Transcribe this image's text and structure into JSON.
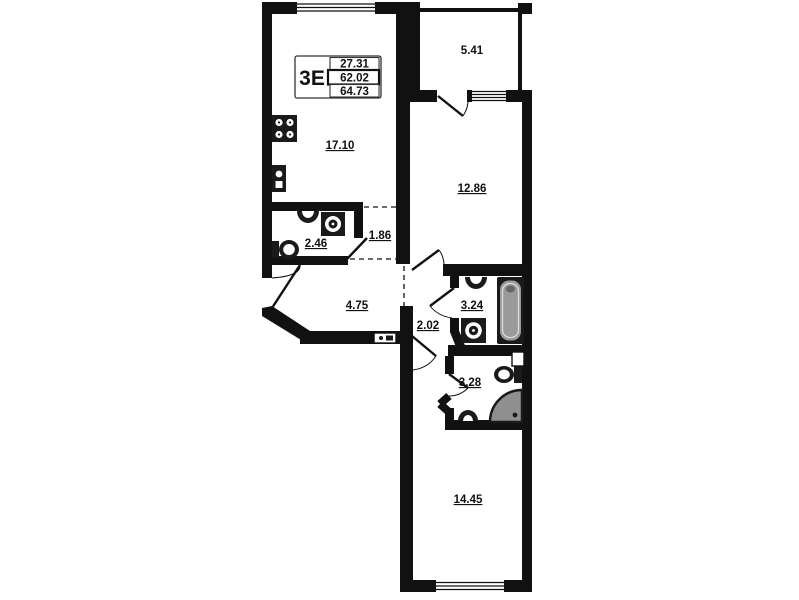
{
  "plan": {
    "title": "apartment-floor-plan",
    "legend": {
      "unit_type": "3Е",
      "values": [
        "27.31",
        "62.02",
        "64.73"
      ]
    },
    "rooms": {
      "balcony": "5.41",
      "kitchen_living": "17.10",
      "bedroom1": "12.86",
      "bathroom1": "2.46",
      "wardrobe": "1.86",
      "hallway": "4.75",
      "vestibule": "2.02",
      "bathroom2": "3.24",
      "wc": "3.28",
      "bedroom2": "14.45"
    },
    "colors": {
      "wall": "#111111",
      "fixture": "#1a1a1a",
      "tub_fill": "#9a9a9a",
      "shower_fill": "#8f8f8f",
      "background": "#ffffff"
    }
  }
}
